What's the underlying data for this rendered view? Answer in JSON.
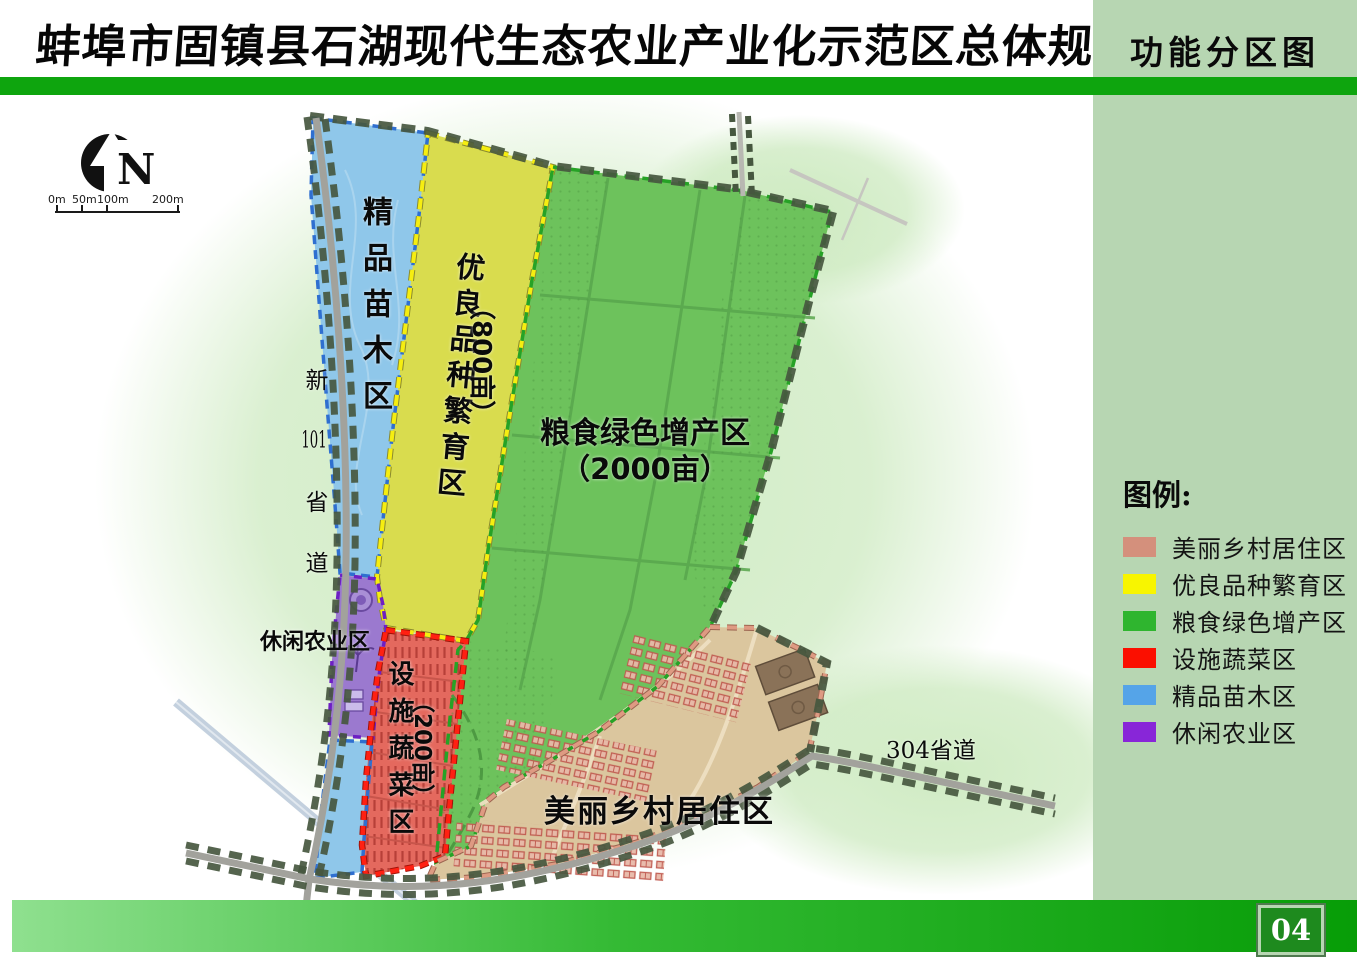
{
  "header": {
    "title": "蚌埠市固镇县石湖现代生态农业产业化示范区总体规划",
    "map_title": "功能分区图"
  },
  "legend": {
    "title": "图例:",
    "items": [
      {
        "label": "美丽乡村居住区",
        "color": "#d4907c"
      },
      {
        "label": "优良品种繁育区",
        "color": "#f8f500"
      },
      {
        "label": "粮食绿色增产区",
        "color": "#2fb52f"
      },
      {
        "label": "设施蔬菜区",
        "color": "#fb0f00"
      },
      {
        "label": "精品苗木区",
        "color": "#55a4e8"
      },
      {
        "label": "休闲农业区",
        "color": "#8826d8"
      }
    ]
  },
  "zones": {
    "jingpin_miaomu": {
      "label": "精品苗木区",
      "color": "#8fc7ea"
    },
    "youliang_pinzhong": {
      "label": "优良品种繁育区",
      "area": "（800亩）",
      "color": "#d9dc4e"
    },
    "liangshi_lvse": {
      "label": "粮食绿色增产区",
      "area": "（2000亩）",
      "color": "#6dc25c"
    },
    "sheshi_shucai": {
      "label": "设施蔬菜区",
      "area": "（200亩）",
      "color": "#e4695e"
    },
    "xiuxian_nongye": {
      "label": "休闲农业区",
      "color": "#9b79cf"
    },
    "meili_xiangcun": {
      "label": "美丽乡村居住区",
      "color": "#dbc69e"
    },
    "strip_color": "#8fc7ea"
  },
  "roads": {
    "r101": {
      "parts": [
        "新",
        "101",
        "省",
        "道"
      ]
    },
    "r304": {
      "label": "304省道"
    }
  },
  "north_label": "N",
  "scale_ticks": [
    "0m",
    "50m",
    "100m",
    "200m"
  ],
  "page_number": "04"
}
